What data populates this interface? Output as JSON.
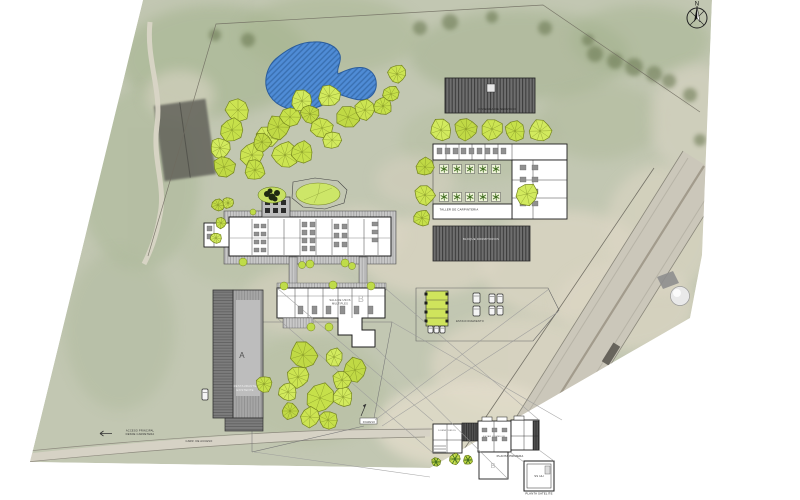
{
  "meta": {
    "sheet_type": "architectural site plan",
    "canvas_w": 800,
    "canvas_h": 500
  },
  "colors": {
    "photo_base": "#c2c7b2",
    "pond_fill": "#4f8cd6",
    "pond_line": "#2a5c9c",
    "tree_palette": [
      "#cce452",
      "#c6e04a",
      "#d2ea5e",
      "#c0d945"
    ],
    "tree_stroke": "#74841e",
    "tree_spoke": "#6e7e1c",
    "bush_fill": "#bfdc49",
    "planter_tree": "#3f6d1f",
    "roof_dark": "#6e6e6e",
    "module_green": "#cfe45c",
    "olive_blob": "#66754e",
    "sand_patch": "#dcd6c4",
    "leader_line": "#9a9a9a"
  },
  "labels": [
    {
      "id": "north",
      "text": "N",
      "x": 697,
      "y": 5.5,
      "size": 6,
      "color": "#111"
    },
    {
      "id": "roof-top",
      "text": "VIVIENDA DE SERVICIO",
      "x": 497,
      "y": 110,
      "size": 3,
      "color": "#1b1b1b"
    },
    {
      "id": "taller",
      "text": "TALLER DE CARPINTERIA",
      "x": 459,
      "y": 210.5,
      "size": 2.8,
      "color": "#222"
    },
    {
      "id": "roof-b",
      "text": "BLOQUE DORMITORIOS",
      "x": 481,
      "y": 240,
      "size": 2.8,
      "color": "#e8e8e8"
    },
    {
      "id": "letter-b",
      "text": "B",
      "x": 361,
      "y": 302,
      "size": 9,
      "color": "#b9b9b9"
    },
    {
      "id": "b-note-1",
      "text": "SALA DE USOS",
      "x": 340,
      "y": 301,
      "size": 2.6,
      "color": "#444"
    },
    {
      "id": "b-note-2",
      "text": "MULTIPLES",
      "x": 340,
      "y": 304.5,
      "size": 2.6,
      "color": "#444"
    },
    {
      "id": "letter-a",
      "text": "A",
      "x": 242,
      "y": 358,
      "size": 8,
      "color": "#4f4f4f"
    },
    {
      "id": "rest-1",
      "text": "RESTAURANTE",
      "x": 245,
      "y": 387,
      "size": 2.8,
      "color": "#f2f2f2"
    },
    {
      "id": "rest-2",
      "text": "EXISTENTE",
      "x": 245,
      "y": 391,
      "size": 2.8,
      "color": "#f2f2f2"
    },
    {
      "id": "parking",
      "text": "ESTACIONAMIENTO",
      "x": 470,
      "y": 322,
      "size": 2.6,
      "color": "#333"
    },
    {
      "id": "acceso-1",
      "text": "ACCESO PRINCIPAL",
      "x": 140,
      "y": 431.5,
      "size": 2.6,
      "color": "#333"
    },
    {
      "id": "acceso-2",
      "text": "DESDE CARRETERA",
      "x": 140,
      "y": 435,
      "size": 2.6,
      "color": "#333"
    },
    {
      "id": "carr",
      "text": "CARR. DE ACCESO",
      "x": 199,
      "y": 442,
      "size": 2.6,
      "color": "#333"
    },
    {
      "id": "ingreso",
      "text": "INGRESO",
      "x": 369,
      "y": 422.8,
      "size": 2.4,
      "color": "#333"
    },
    {
      "id": "planta-primera",
      "text": "PLANTA PRIMERA",
      "x": 510,
      "y": 457,
      "size": 2.8,
      "color": "#222"
    },
    {
      "id": "detail-b",
      "text": "B",
      "x": 493,
      "y": 468,
      "size": 7,
      "color": "#b5b5b5"
    },
    {
      "id": "detail-note1",
      "text": "DORMITORIOS",
      "x": 447,
      "y": 431,
      "size": 2.2,
      "color": "#555"
    },
    {
      "id": "detail-note2",
      "text": "ESTAR COMEDOR",
      "x": 494,
      "y": 437,
      "size": 2.2,
      "color": "#555"
    },
    {
      "id": "sshh",
      "text": "SS HH",
      "x": 539,
      "y": 477,
      "size": 2.8,
      "color": "#333"
    },
    {
      "id": "planta-satelite",
      "text": "PLANTA SATELITE",
      "x": 539,
      "y": 494.5,
      "size": 2.8,
      "color": "#222"
    }
  ],
  "photo": {
    "patches": [
      {
        "x": 215,
        "y": 60,
        "rx": 95,
        "ry": 55,
        "c": "#a3b28d",
        "o": 0.55
      },
      {
        "x": 330,
        "y": 35,
        "rx": 90,
        "ry": 40,
        "c": "#a8b691",
        "o": 0.5
      },
      {
        "x": 520,
        "y": 55,
        "rx": 110,
        "ry": 45,
        "c": "#9fae89",
        "o": 0.45
      },
      {
        "x": 640,
        "y": 40,
        "rx": 70,
        "ry": 35,
        "c": "#a3b28d",
        "o": 0.45
      },
      {
        "x": 140,
        "y": 180,
        "rx": 60,
        "ry": 90,
        "c": "#a9b795",
        "o": 0.5
      },
      {
        "x": 120,
        "y": 330,
        "rx": 55,
        "ry": 80,
        "c": "#aeb99c",
        "o": 0.45
      },
      {
        "x": 480,
        "y": 140,
        "rx": 80,
        "ry": 40,
        "c": "#b2bd9e",
        "o": 0.4
      },
      {
        "x": 240,
        "y": 250,
        "rx": 60,
        "ry": 35,
        "c": "#b6c0a3",
        "o": 0.4
      },
      {
        "x": 600,
        "y": 120,
        "rx": 60,
        "ry": 40,
        "c": "#aab694",
        "o": 0.4
      },
      {
        "x": 430,
        "y": 255,
        "rx": 70,
        "ry": 40,
        "c": "#dcd6c4",
        "o": 0.7
      },
      {
        "x": 565,
        "y": 265,
        "rx": 85,
        "ry": 55,
        "c": "#dcd6c4",
        "o": 0.75
      },
      {
        "x": 625,
        "y": 305,
        "rx": 70,
        "ry": 45,
        "c": "#dcd6c4",
        "o": 0.7
      },
      {
        "x": 515,
        "y": 365,
        "rx": 85,
        "ry": 50,
        "c": "#dcd6c4",
        "o": 0.75
      },
      {
        "x": 470,
        "y": 425,
        "rx": 95,
        "ry": 45,
        "c": "#e2dcca",
        "o": 0.8
      },
      {
        "x": 360,
        "y": 235,
        "rx": 45,
        "ry": 28,
        "c": "#dcd6c4",
        "o": 0.6
      },
      {
        "x": 300,
        "y": 300,
        "rx": 55,
        "ry": 35,
        "c": "#d8d2c0",
        "o": 0.5
      },
      {
        "x": 660,
        "y": 230,
        "rx": 55,
        "ry": 65,
        "c": "#dcd6c4",
        "o": 0.6
      },
      {
        "x": 695,
        "y": 120,
        "rx": 45,
        "ry": 55,
        "c": "#d9d4c4",
        "o": 0.55
      },
      {
        "x": 180,
        "y": 95,
        "rx": 35,
        "ry": 25,
        "c": "#d9d4c4",
        "o": 0.6
      },
      {
        "x": 415,
        "y": 180,
        "rx": 40,
        "ry": 25,
        "c": "#d6d0bf",
        "o": 0.5
      },
      {
        "x": 310,
        "y": 390,
        "rx": 75,
        "ry": 55,
        "c": "#b3bd9d",
        "o": 0.45
      }
    ],
    "blobs": [
      [
        595,
        54,
        8
      ],
      [
        615,
        61,
        8
      ],
      [
        634,
        67,
        9
      ],
      [
        654,
        74,
        8
      ],
      [
        669,
        81,
        7
      ],
      [
        588,
        40,
        6
      ],
      [
        545,
        28,
        7
      ],
      [
        450,
        22,
        8
      ],
      [
        420,
        28,
        7
      ],
      [
        492,
        17,
        6
      ],
      [
        248,
        40,
        7
      ],
      [
        215,
        35,
        6
      ],
      [
        690,
        95,
        7
      ],
      [
        700,
        140,
        6
      ]
    ]
  },
  "trees": [
    [
      238,
      110,
      13
    ],
    [
      232,
      130,
      13
    ],
    [
      220,
      148,
      11
    ],
    [
      224,
      167,
      12
    ],
    [
      252,
      155,
      13
    ],
    [
      255,
      170,
      11
    ],
    [
      267,
      137,
      12
    ],
    [
      278,
      127,
      13
    ],
    [
      285,
      155,
      14
    ],
    [
      290,
      117,
      11
    ],
    [
      302,
      101,
      12
    ],
    [
      310,
      114,
      10
    ],
    [
      322,
      128,
      12
    ],
    [
      302,
      152,
      12
    ],
    [
      329,
      96,
      12
    ],
    [
      348,
      117,
      13
    ],
    [
      365,
      110,
      11
    ],
    [
      383,
      106,
      10
    ],
    [
      332,
      140,
      10
    ],
    [
      262,
      142,
      10
    ],
    [
      397,
      74,
      10
    ],
    [
      391,
      94,
      9
    ],
    [
      441,
      130,
      12
    ],
    [
      466,
      129,
      12
    ],
    [
      492,
      129,
      12
    ],
    [
      515,
      131,
      11
    ],
    [
      540,
      131,
      12
    ],
    [
      425,
      167,
      10
    ],
    [
      425,
      195,
      11
    ],
    [
      422,
      218,
      9
    ],
    [
      527,
      194,
      12
    ],
    [
      303,
      355,
      15
    ],
    [
      298,
      377,
      12
    ],
    [
      320,
      398,
      16
    ],
    [
      288,
      392,
      10
    ],
    [
      290,
      411,
      9
    ],
    [
      310,
      417,
      11
    ],
    [
      328,
      420,
      10
    ],
    [
      343,
      397,
      11
    ],
    [
      355,
      370,
      13
    ],
    [
      342,
      380,
      10
    ],
    [
      264,
      384,
      9
    ],
    [
      334,
      357,
      10
    ],
    [
      218,
      205,
      7
    ],
    [
      228,
      203,
      6
    ],
    [
      221,
      223,
      6
    ],
    [
      216,
      238,
      6
    ]
  ],
  "bushes": [
    [
      243,
      262,
      4
    ],
    [
      310,
      264,
      4
    ],
    [
      345,
      263,
      4
    ],
    [
      302,
      265,
      3.5
    ],
    [
      352,
      266,
      3.5
    ],
    [
      284,
      286,
      4
    ],
    [
      333,
      285,
      4
    ],
    [
      371,
      286,
      4
    ],
    [
      311,
      327,
      4
    ],
    [
      329,
      327,
      4
    ],
    [
      253,
      212,
      3
    ]
  ],
  "star_trees": [
    [
      436,
      462,
      5
    ],
    [
      455,
      459,
      6
    ],
    [
      468,
      460,
      5
    ]
  ],
  "planters": {
    "size": 9,
    "rows": [
      {
        "y": 169,
        "xs": [
          444,
          457,
          470,
          483,
          496
        ]
      },
      {
        "y": 197,
        "xs": [
          444,
          457,
          470,
          483,
          496
        ]
      }
    ]
  },
  "furniture": [
    {
      "x": 254,
      "y": 224,
      "cols": 2,
      "rows": 4,
      "dx": 7,
      "dy": 8,
      "w": 5,
      "h": 4
    },
    {
      "x": 302,
      "y": 222,
      "cols": 2,
      "rows": 4,
      "dx": 8,
      "dy": 8,
      "w": 5,
      "h": 5
    },
    {
      "x": 334,
      "y": 224,
      "cols": 2,
      "rows": 3,
      "dx": 8,
      "dy": 9,
      "w": 5,
      "h": 5
    },
    {
      "x": 372,
      "y": 222,
      "cols": 1,
      "rows": 3,
      "dx": 0,
      "dy": 8,
      "w": 6,
      "h": 4
    },
    {
      "x": 298,
      "y": 306,
      "cols": 6,
      "rows": 1,
      "dx": 14,
      "dy": 0,
      "w": 5,
      "h": 8
    },
    {
      "x": 437,
      "y": 148,
      "cols": 9,
      "rows": 1,
      "dx": 8,
      "dy": 0,
      "w": 5,
      "h": 6
    },
    {
      "x": 520,
      "y": 165,
      "cols": 2,
      "rows": 4,
      "dx": 12,
      "dy": 12,
      "w": 6,
      "h": 5
    },
    {
      "x": 482,
      "y": 428,
      "cols": 3,
      "rows": 2,
      "dx": 10,
      "dy": 9,
      "w": 5,
      "h": 4
    },
    {
      "x": 207,
      "y": 226,
      "cols": 1,
      "rows": 2,
      "dx": 0,
      "dy": 8,
      "w": 5,
      "h": 5
    }
  ],
  "cars": [
    {
      "x": 473,
      "y": 293,
      "w": 7,
      "h": 10
    },
    {
      "x": 473,
      "y": 306,
      "w": 7,
      "h": 10
    },
    {
      "x": 489,
      "y": 294,
      "w": 6,
      "h": 9
    },
    {
      "x": 497,
      "y": 294,
      "w": 6,
      "h": 9
    },
    {
      "x": 489,
      "y": 306,
      "w": 6,
      "h": 9
    },
    {
      "x": 497,
      "y": 306,
      "w": 6,
      "h": 9
    },
    {
      "x": 428,
      "y": 326,
      "w": 5,
      "h": 7
    },
    {
      "x": 434,
      "y": 326,
      "w": 5,
      "h": 7
    },
    {
      "x": 440,
      "y": 326,
      "w": 5,
      "h": 7
    },
    {
      "x": 202,
      "y": 389,
      "w": 6,
      "h": 11
    }
  ],
  "lines": [
    [
      277,
      288,
      433,
      421
    ],
    [
      385,
      288,
      539,
      420
    ],
    [
      375,
      347,
      508,
      479
    ],
    [
      277,
      318,
      433,
      453
    ],
    [
      549,
      289,
      375,
      420
    ],
    [
      558,
      312,
      382,
      426
    ],
    [
      510,
      452,
      524,
      462
    ],
    [
      539,
      450,
      554,
      461
    ],
    [
      392,
      322,
      562,
      420
    ],
    [
      254,
      452,
      430,
      477
    ]
  ]
}
